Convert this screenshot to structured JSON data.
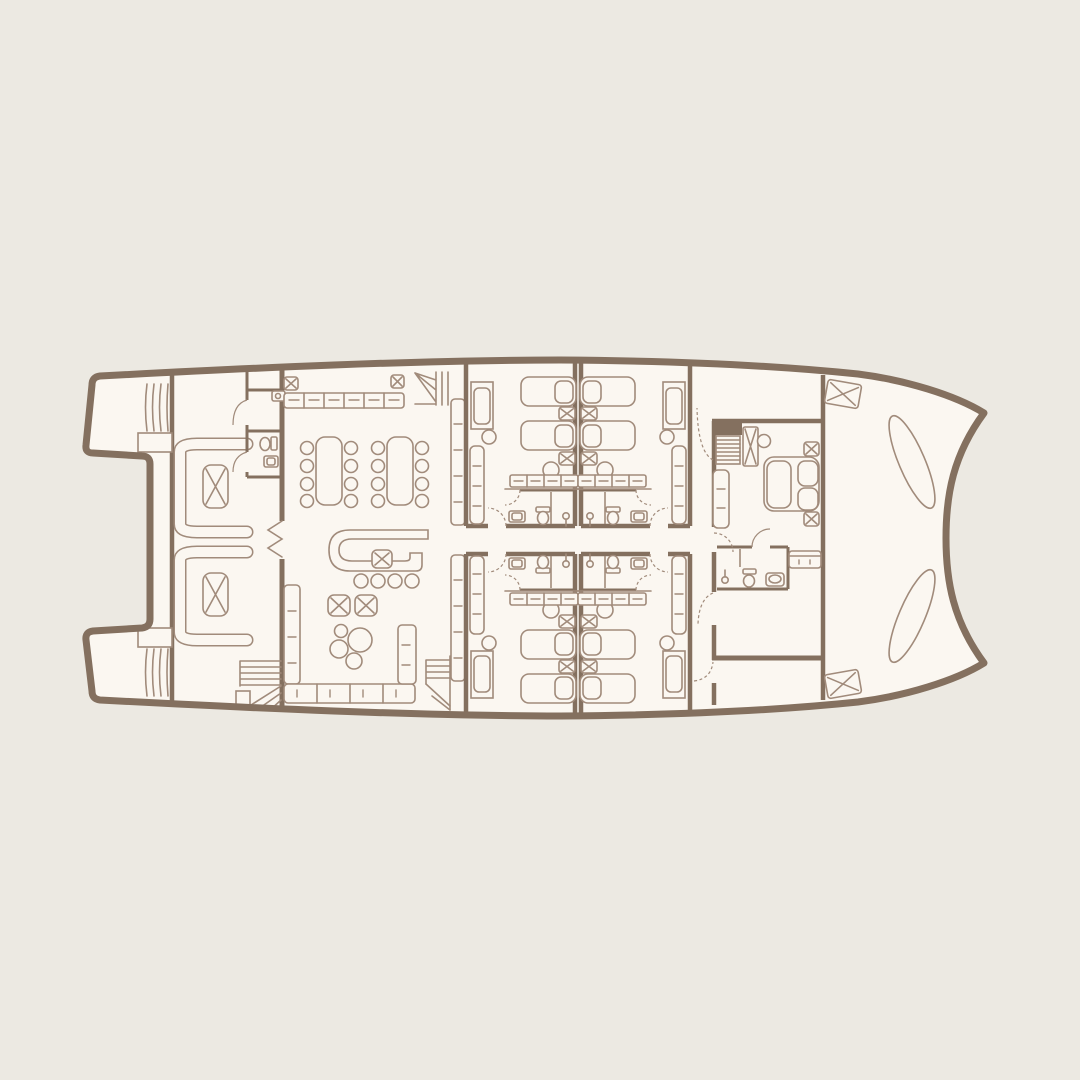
{
  "colors": {
    "background": "#ECE9E2",
    "interior": "#FBF7F1",
    "line_bold": "#84705F",
    "line": "#A18B7B"
  },
  "diagram": {
    "type": "floor-plan",
    "subject": "catamaran-yacht-main-deck",
    "areas": [
      {
        "name": "stern-hulls",
        "items": [
          "swim-steps",
          "swim-steps",
          "boarding-platform",
          "boarding-platform"
        ]
      },
      {
        "name": "aft-cockpit",
        "items": [
          "curved-bench",
          "curved-bench",
          "x-table",
          "x-table",
          "wc-toilet",
          "wc-sink",
          "wc-washbasin",
          "stairs-up"
        ]
      },
      {
        "name": "salon",
        "items": [
          "galley-counter",
          "ceiling-hatch",
          "ceiling-hatch",
          "dining-table",
          "dining-table",
          "dining-chairs-x16",
          "bar-counter",
          "bar-table",
          "bar-stools-x4",
          "x-table",
          "x-table",
          "lounge-chair-cluster",
          "sofa-left",
          "sofa-bottom",
          "sofa-right",
          "wall-sofa",
          "wall-sofa",
          "stairs-down",
          "stairs-down"
        ]
      },
      {
        "name": "guest-cabin-top-left",
        "items": [
          "single-bed",
          "single-bed",
          "x-nightstand",
          "x-nightstand",
          "armchair",
          "stool",
          "stool",
          "bench-seat",
          "vanity-desk",
          "bath-sink",
          "bath-toilet",
          "bath-shower"
        ]
      },
      {
        "name": "guest-cabin-top-right",
        "items": [
          "mirror-of-top-left"
        ]
      },
      {
        "name": "guest-cabin-bottom-left",
        "items": [
          "mirror-of-top-left"
        ]
      },
      {
        "name": "guest-cabin-bottom-right",
        "items": [
          "mirror-of-top-left"
        ]
      },
      {
        "name": "corridor",
        "items": []
      },
      {
        "name": "master-suite",
        "items": [
          "double-bed",
          "pillow",
          "pillow",
          "x-nightstand",
          "x-nightstand",
          "companionway-ladder",
          "x-wardrobe",
          "stool",
          "bench-seat",
          "bath-shower",
          "bath-toilet",
          "bath-sink",
          "settee"
        ]
      },
      {
        "name": "foredeck",
        "items": [
          "deck-hatch",
          "deck-hatch",
          "hull-top-ellipse",
          "hull-top-ellipse"
        ]
      }
    ]
  }
}
